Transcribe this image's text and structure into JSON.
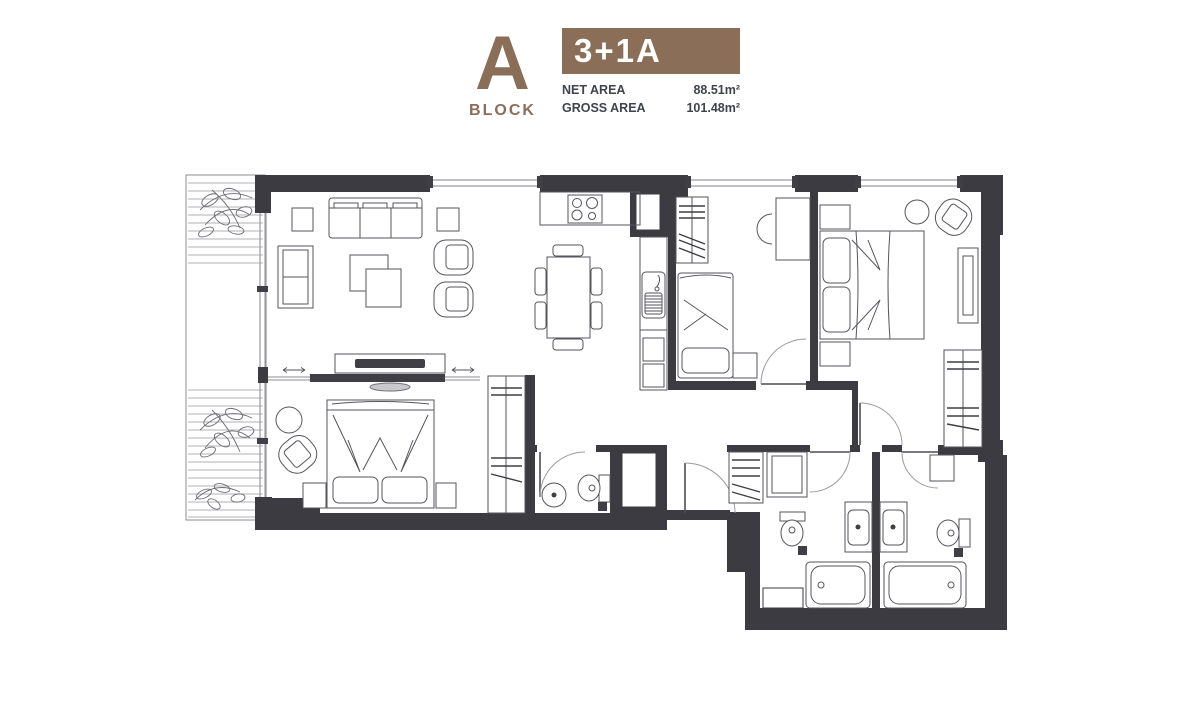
{
  "header": {
    "block_letter": "A",
    "block_label": "BLOCK",
    "unit_type": "3+1A",
    "net_area_label": "NET AREA",
    "net_area_value": "88.51m²",
    "gross_area_label": "GROSS AREA",
    "gross_area_value": "101.48m²"
  },
  "colors": {
    "brown": "#8b6e58",
    "wall": "#3b3b41",
    "ink": "#3f434c"
  },
  "plan": {
    "type": "apartment-floor-plan",
    "rooms": [
      "balcony",
      "living-room",
      "kitchen",
      "dining-area",
      "bedroom-2",
      "master-bedroom",
      "dressing-area",
      "bedroom-3",
      "wc",
      "bathroom-left",
      "bathroom-right",
      "hall"
    ]
  }
}
